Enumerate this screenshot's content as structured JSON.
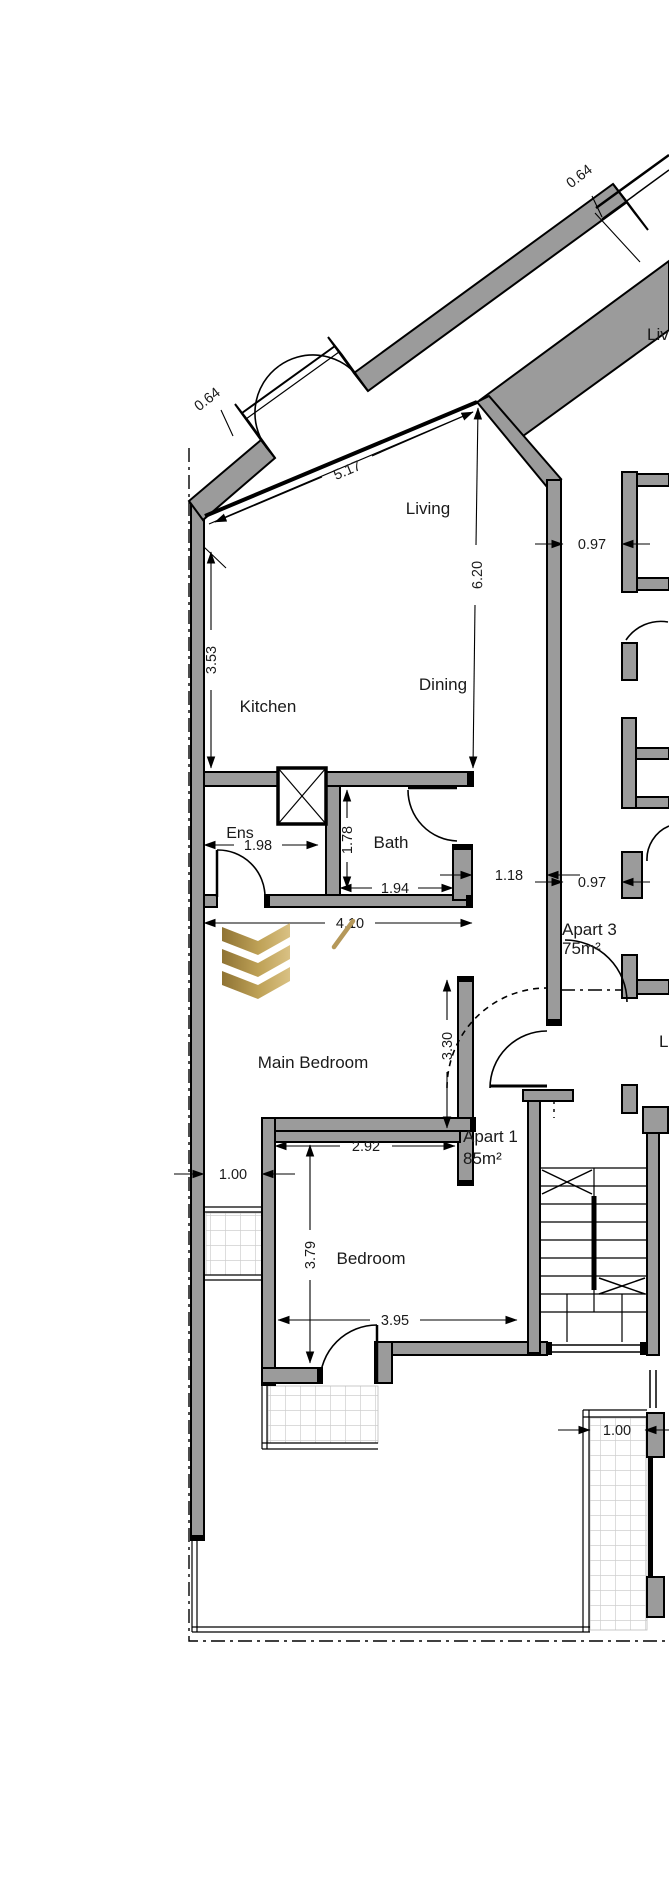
{
  "meta": {
    "drawing_type": "apartment floor plan"
  },
  "rooms": {
    "living": "Living",
    "dining": "Dining",
    "kitchen": "Kitchen",
    "ens": "Ens",
    "bath": "Bath",
    "main_bedroom": "Main Bedroom",
    "bedroom": "Bedroom"
  },
  "apartments": {
    "apart1_name": "Apart 1",
    "apart1_area": "85m²",
    "apart3_name": "Apart 3",
    "apart3_area": "75m²"
  },
  "adjacent_partial_labels": {
    "living_top": "Liv",
    "living_mid": "Li"
  },
  "dims": {
    "offset_top": "0.64",
    "offset_entrance": "0.64",
    "facade": "5.17",
    "kitchen_side": "3.53",
    "living_length": "6.20",
    "gap_upper": "0.97",
    "gap_lower": "0.97",
    "ens_width": "1.98",
    "bath_depth": "1.78",
    "bath_width": "1.94",
    "hall_gap": "1.18",
    "corridor": "4.10",
    "entry_wall": "3.30",
    "bedroom_width": "2.92",
    "side_strip": "1.00",
    "bedroom_depth": "3.79",
    "bedroom_span": "3.95",
    "terrace_strip": "1.00"
  },
  "colors": {
    "wall_fill": "#9b9b9b",
    "line": "#000000",
    "logo_gold_dark": "#8f7334",
    "logo_gold_light": "#d9c184"
  }
}
